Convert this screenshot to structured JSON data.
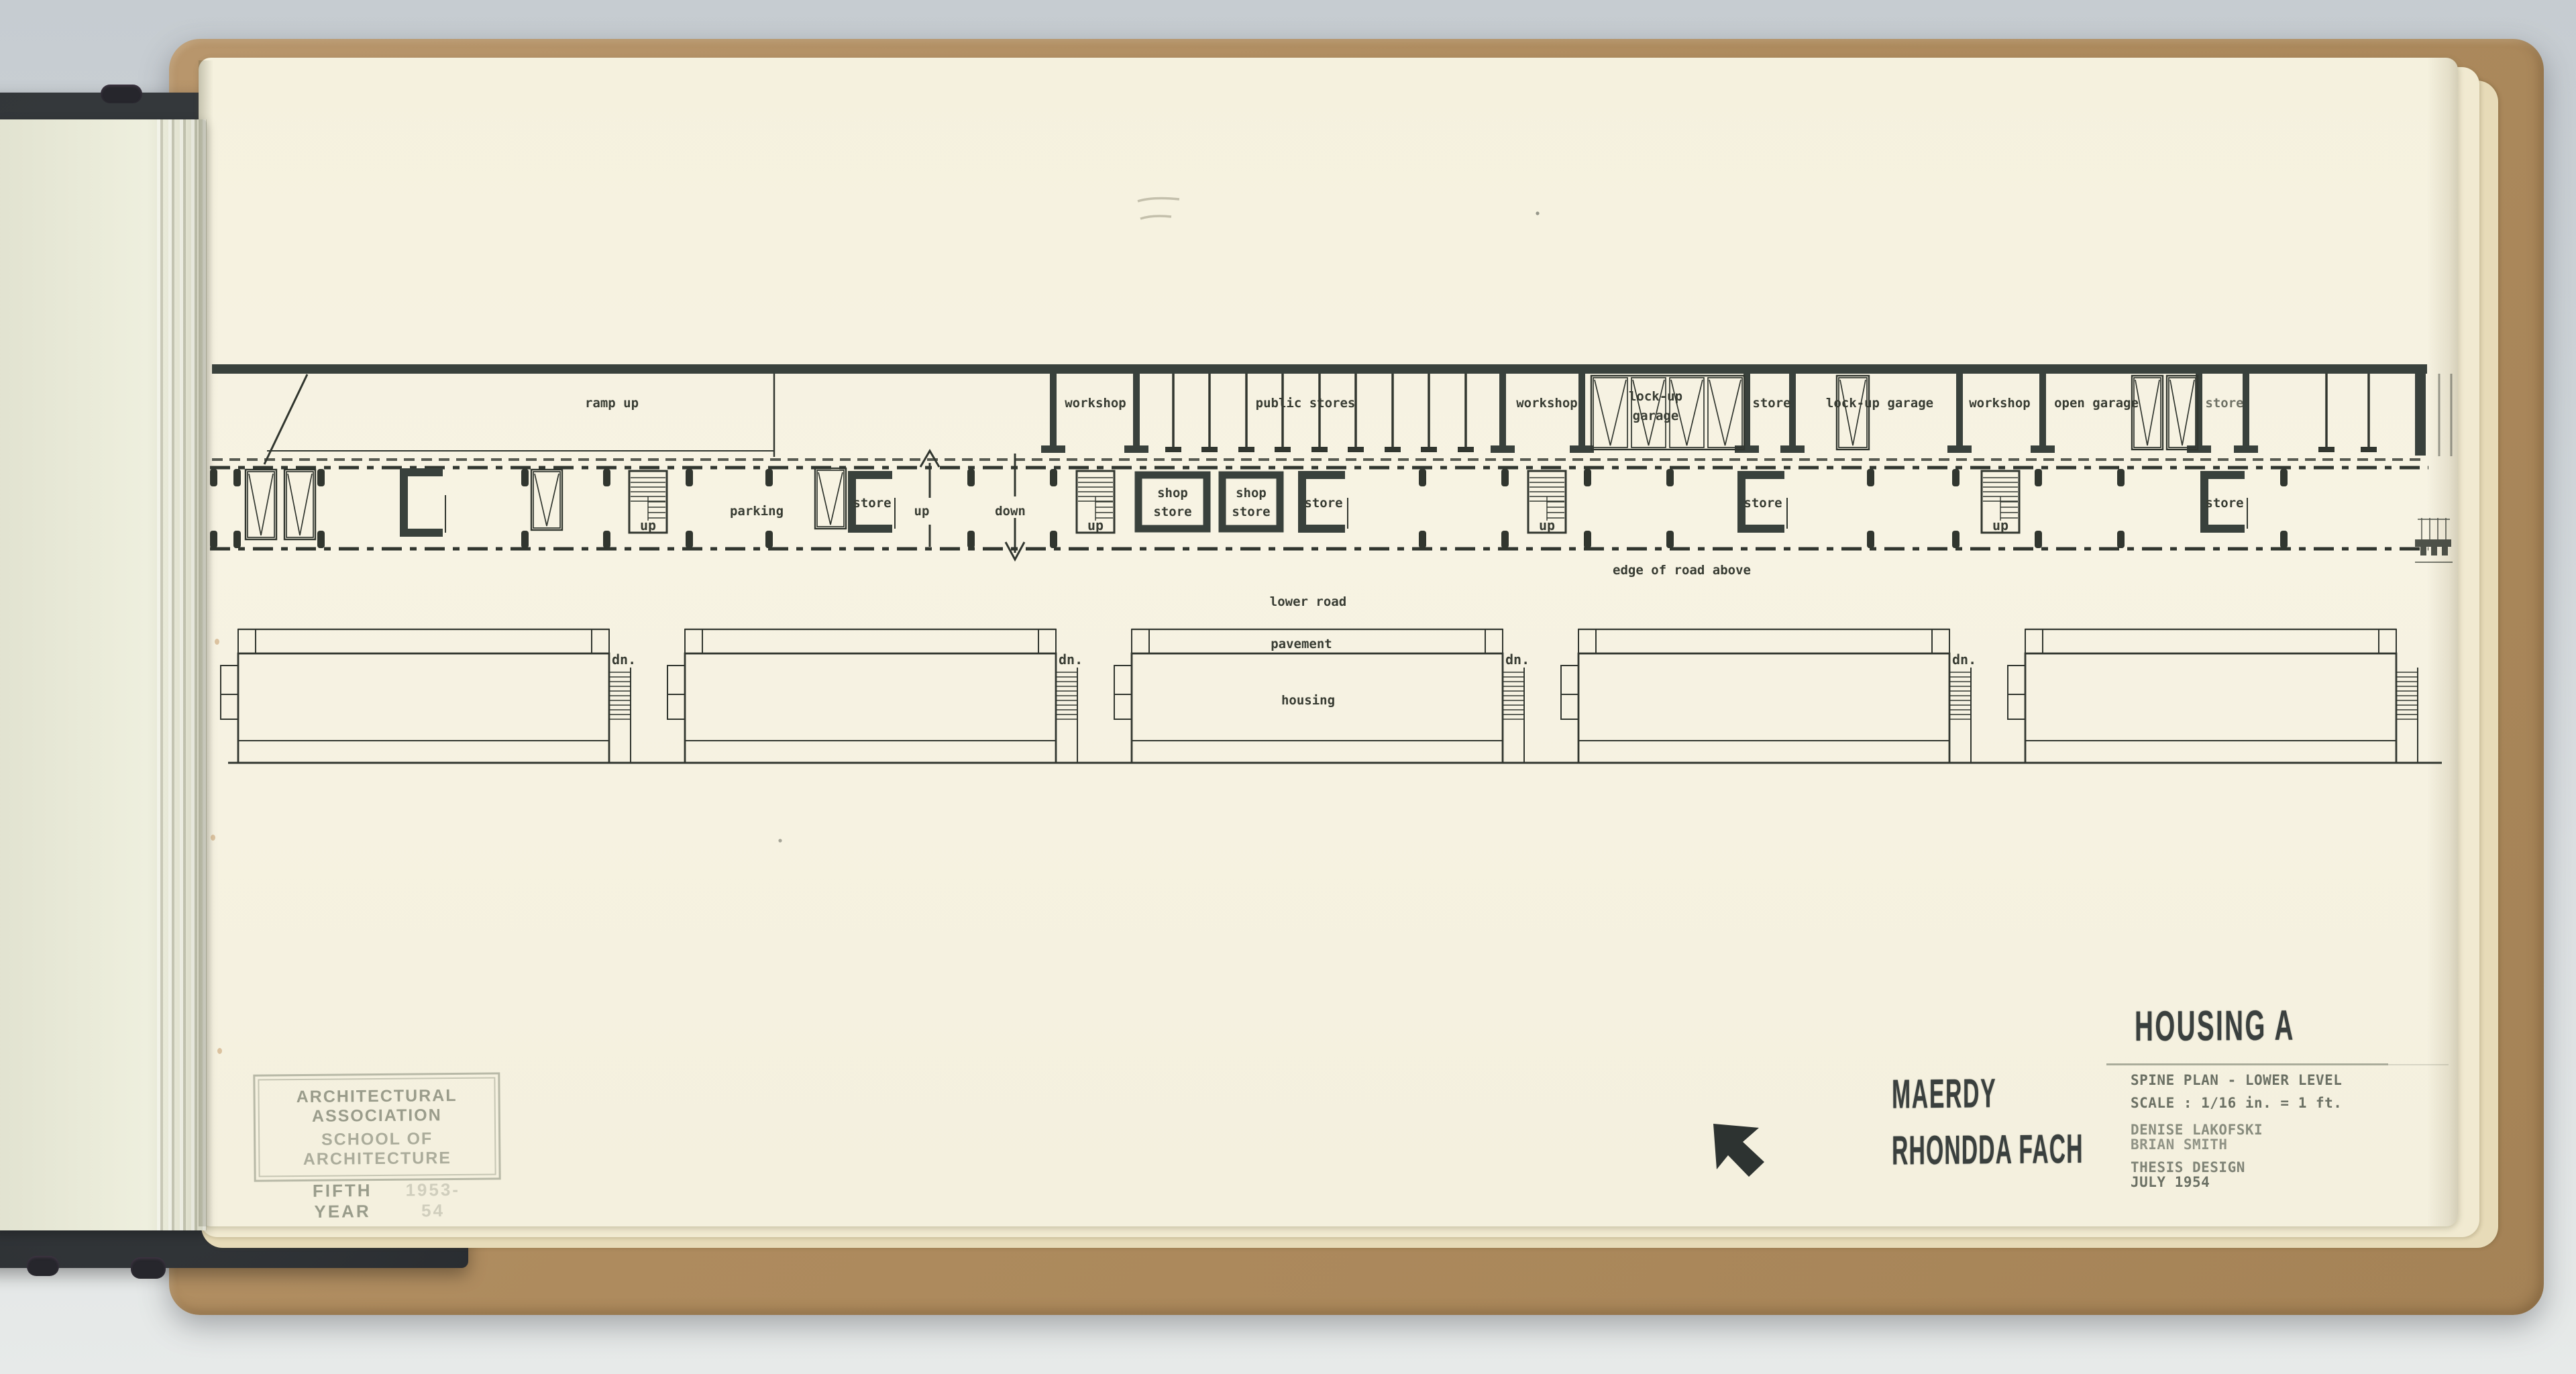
{
  "plan_labels": {
    "ramp_up": "ramp up",
    "workshop": "workshop",
    "public_stores": "public stores",
    "lock_up": "lock-up",
    "garage": "garage",
    "lock_up_garage": "lock-up garage",
    "open_garage": "open garage",
    "store": "store",
    "shop": "shop",
    "parking": "parking",
    "up": "up",
    "down": "down",
    "dn": "dn.",
    "edge_of_road_above": "edge of road above",
    "lower_road": "lower road",
    "pavement": "pavement",
    "housing": "housing"
  },
  "title_block": {
    "project": "HOUSING A",
    "drawing_title": "SPINE PLAN - LOWER LEVEL",
    "scale": "SCALE : 1/16 in. = 1 ft.",
    "author_1": "DENISE LAKOFSKI",
    "author_2": "BRIAN SMITH",
    "submission": "THESIS DESIGN",
    "date": "JULY 1954"
  },
  "location_stamp": {
    "line_1": "MAERDY",
    "line_2": "RHONDDA FACH"
  },
  "school_stamp": {
    "line_1": "ARCHITECTURAL ASSOCIATION",
    "line_2": "SCHOOL OF ARCHITECTURE",
    "line_3": "FIFTH YEAR",
    "session": "1953-54"
  },
  "icons": {
    "north_arrow": "north-arrow-icon"
  },
  "colors": {
    "ink": "#31362f",
    "wall": "#39413c",
    "stamp_ink": "#3a403e",
    "typed_faded": "#6b7064",
    "stamp_faded": "#7c8171",
    "page": "#f5f1de",
    "under_page": "#f1ead1",
    "board": "#ae8b5e",
    "cover": "#33373a",
    "background_top": "#c6ccd1",
    "background_bottom": "#e7eae9"
  }
}
